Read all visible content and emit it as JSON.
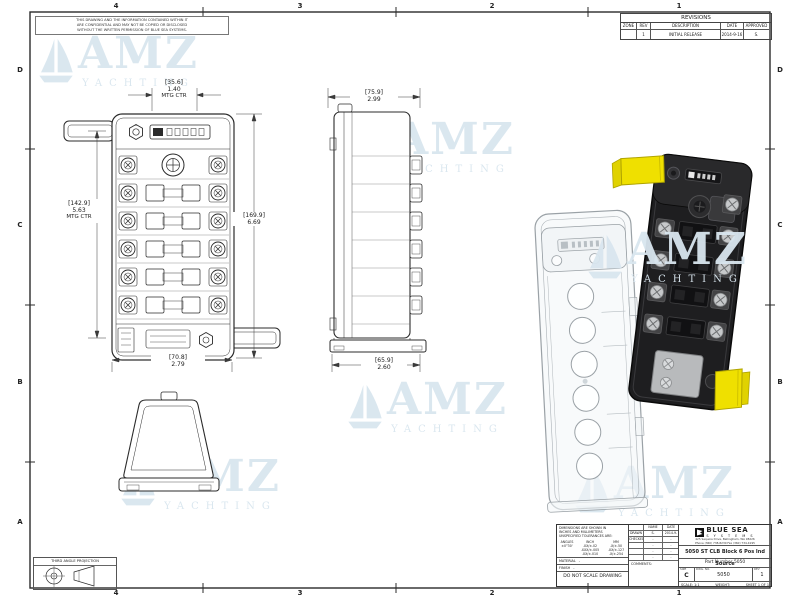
{
  "sheet": {
    "zones": {
      "cols": [
        "4",
        "3",
        "2",
        "1"
      ],
      "rows": [
        "D",
        "C",
        "B",
        "A"
      ]
    },
    "disclaimer": [
      "THIS DRAWING AND THE INFORMATION CONTAINED WITHIN IT",
      "ARE CONFIDENTIAL AND MAY NOT BE COPIED OR DISCLOSED",
      "WITHOUT THE WRITTEN PERMISSION OF BLUE SEA SYSTEMS."
    ]
  },
  "revisions": {
    "title": "REVISIONS",
    "headers": [
      "ZONE",
      "REV",
      "DESCRIPTION",
      "DATE",
      "APPROVED"
    ],
    "rows": [
      {
        "zone": "",
        "rev": "1",
        "description": "INITIAL RELEASE",
        "date": "2014-9-16",
        "approved": "S. SOMMERS"
      }
    ]
  },
  "dimensions": {
    "front_top": {
      "mm": "[35.6]",
      "in": "1.40",
      "note": "MTG CTR"
    },
    "front_left": {
      "mm": "[142.9]",
      "in": "5.63",
      "note": "MTG CTR"
    },
    "front_right": {
      "mm": "[169.9]",
      "in": "6.69"
    },
    "front_bottom": {
      "mm": "[70.8]",
      "in": "2.79"
    },
    "side_top": {
      "mm": "[75.9]",
      "in": "2.99"
    },
    "side_bottom": {
      "mm": "[65.9]",
      "in": "2.60"
    }
  },
  "title_block": {
    "tolerances": {
      "line1": "DIMENSIONS ARE SHOWN IN",
      "line2": "INCHES AND MILLIMETERS",
      "line3": "UNSPECIFIED TOLERANCES ARE:",
      "col_angles": "ANGLES",
      "col_inch": "INCH",
      "col_mm": "MM",
      "angles_val": "±0°30'",
      "inch_vals": [
        ".XX/±.02",
        ".XXX/±.005",
        ".XX/±.010"
      ],
      "mm_vals": [
        ".X/±.50",
        ".XX/±.127",
        ".X/±.254"
      ]
    },
    "material_label": "MATERIAL",
    "material_value": "-",
    "finish_label": "FINISH",
    "finish_value": "-",
    "do_not_scale": "DO NOT SCALE DRAWING",
    "name_col": "NAME",
    "date_col": "DATE",
    "sign_rows": [
      {
        "label": "DRAWN",
        "name": "S. SOMMERS",
        "date": "2014-9-16"
      },
      {
        "label": "CHECKED",
        "name": "-",
        "date": "-"
      },
      {
        "label": "",
        "name": "-",
        "date": "-"
      },
      {
        "label": "",
        "name": "-",
        "date": "-"
      },
      {
        "label": "",
        "name": "-",
        "date": "-"
      }
    ],
    "comments_label": "COMMENTS:",
    "company": {
      "name_top": "BLUE SEA",
      "name_bottom": "S Y S T E M S",
      "address": "425 Sequoia Drive,  Bellingham, WA 98226",
      "phone": "Phone (360) 738-8230   Fax (360) 734-4195"
    },
    "drawing_title": "5050 ST CLB Block 6 Pos Ind Source",
    "part_number": "Part Number 5050",
    "size_label": "SIZE",
    "size": "C",
    "dwg_label": "DWG. NO.",
    "dwg_no": "5050",
    "rev_label": "REV",
    "rev": "1",
    "scale": "SCALE: 1:1",
    "weight": "WEIGHT:",
    "sheet": "SHEET 1 OF 1"
  },
  "projection": {
    "label": "THIRD ANGLE PROJECTION"
  },
  "watermark": {
    "text": "AMZ",
    "sub": "YACHTING",
    "color": "#d9e6ef"
  },
  "colors": {
    "accent_yellow": "#efe000",
    "body_black": "#1e1e20",
    "line": "#2b2b2b"
  }
}
